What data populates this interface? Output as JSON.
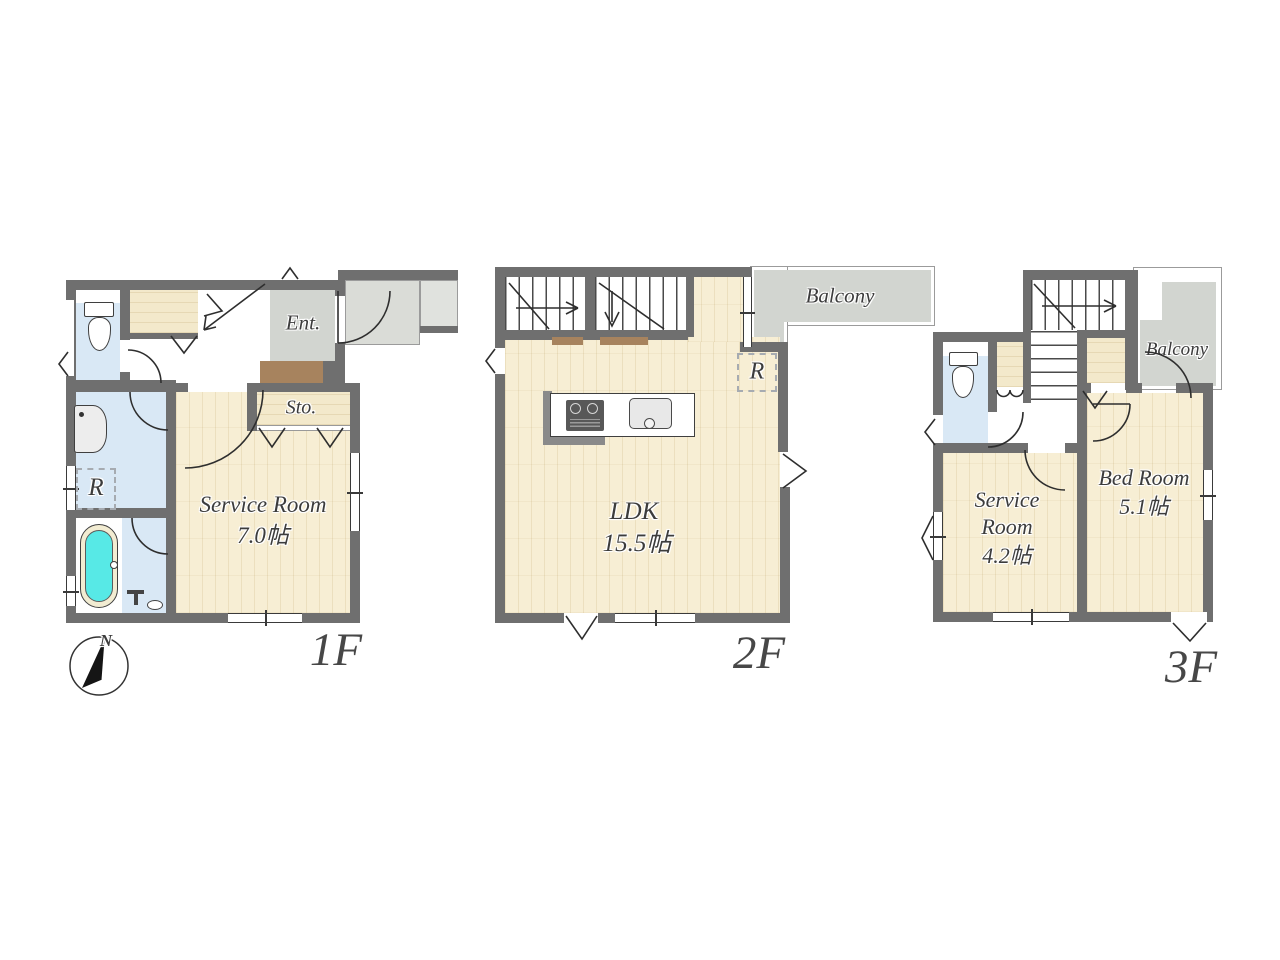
{
  "document": "house floor plan, three storeys",
  "compass": {
    "north": "N"
  },
  "colors": {
    "wall": "#6f6f6f",
    "wood_floor": "#f7eed4",
    "wet_room_blue": "#d9e8f5",
    "tile_grey": "#d2d5d0",
    "bathtub_cyan": "#57e9e6",
    "step_brown": "#a7835e",
    "label_text": "#3c3c3c"
  },
  "floors": [
    {
      "label": "1F",
      "rooms": {
        "entrance": "Ent.",
        "storage": "Sto.",
        "service_room": {
          "name": "Service Room",
          "size": "7.0帖"
        },
        "laundry_symbol": "R"
      }
    },
    {
      "label": "2F",
      "rooms": {
        "ldk": {
          "name": "LDK",
          "size": "15.5帖"
        },
        "balcony": "Balcony",
        "refrigerator_symbol": "R"
      }
    },
    {
      "label": "3F",
      "rooms": {
        "service_room": {
          "line1": "Service",
          "line2": "Room",
          "size": "4.2帖"
        },
        "bed_room": {
          "name": "Bed Room",
          "size": "5.1帖"
        },
        "balcony": "Balcony"
      }
    }
  ]
}
